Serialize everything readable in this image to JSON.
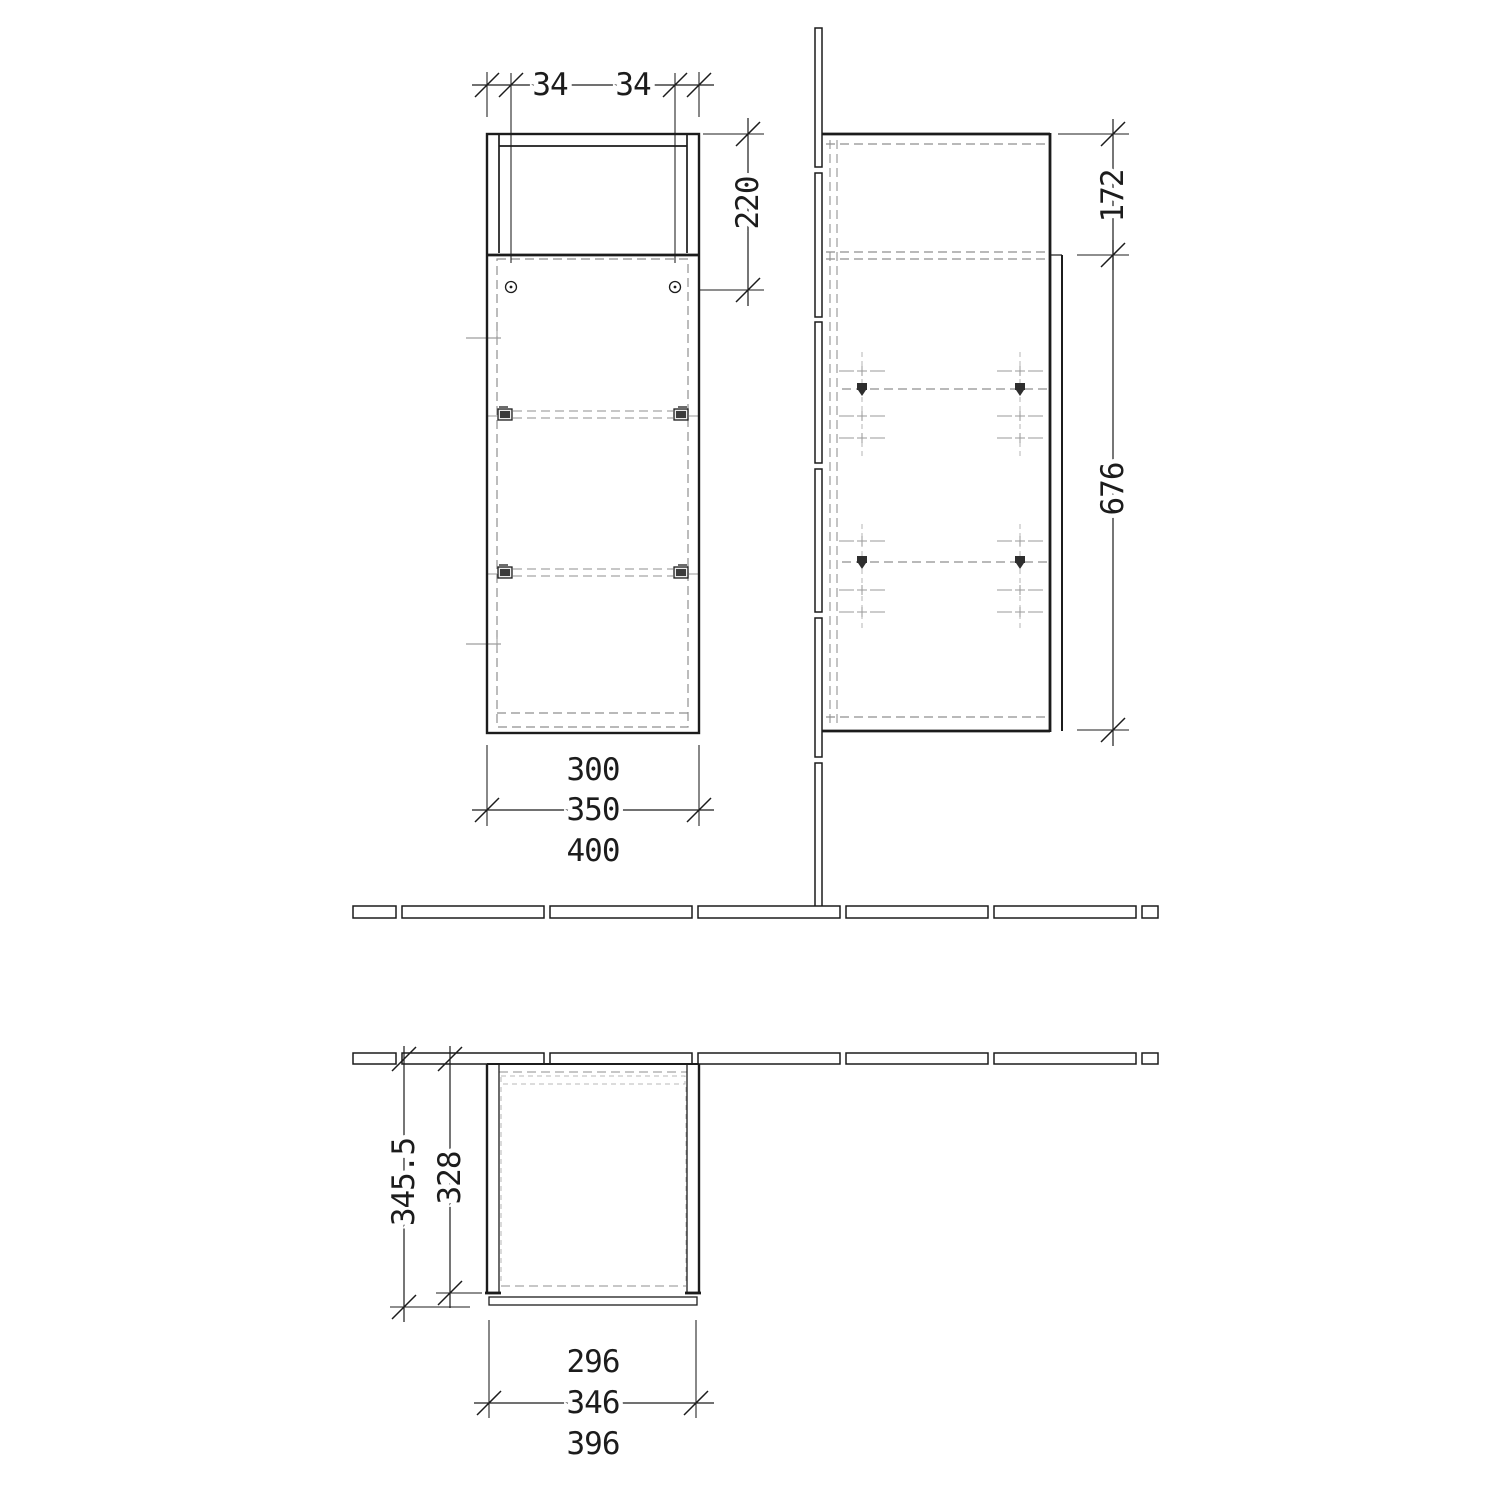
{
  "drawing_title": "cabinet-technical-drawing",
  "front_view": {
    "labels": {
      "hole_offset_left": "34",
      "hole_offset_right": "34",
      "top_section_height": "220",
      "width_inner": "300",
      "width_body": "350",
      "width_outer": "400"
    }
  },
  "side_view": {
    "labels": {
      "upper_height": "172",
      "body_height": "676"
    }
  },
  "plan_view": {
    "labels": {
      "depth_overall": "345.5",
      "depth_body": "328",
      "width_inner": "296",
      "width_body": "346",
      "width_outer": "396"
    }
  }
}
